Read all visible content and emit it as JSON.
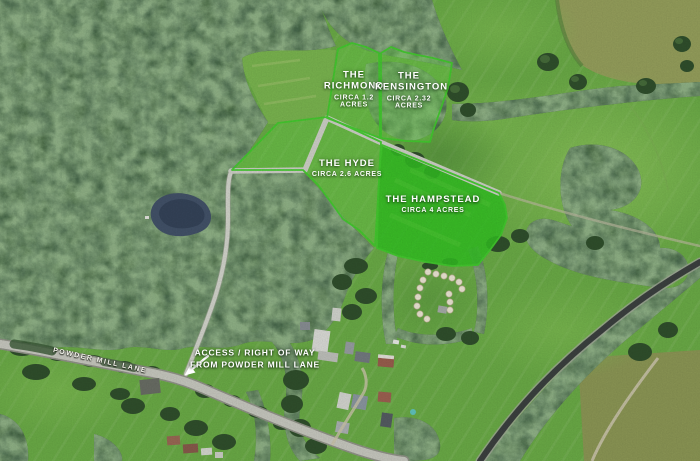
{
  "map_labels": {
    "plots": [
      {
        "name": "THE RICHMOND",
        "area": "CIRCA 1.2 ACRES"
      },
      {
        "name": "THE KENSINGTON",
        "area": "CIRCA 2.32 ACRES"
      },
      {
        "name": "THE HYDE",
        "area": "CIRCA 2.6 ACRES"
      },
      {
        "name": "THE HAMPSTEAD",
        "area": "CIRCA 4 ACRES"
      }
    ],
    "access_note": {
      "line1": "ACCESS / RIGHT OF WAY",
      "line2": "FROM POWDER MILL LANE"
    },
    "road_name": "POWDER MILL LANE"
  },
  "colors": {
    "plot_tint": "rgba(105,215,70,0.38)",
    "plot_highlight": "rgba(50,198,34,0.85)",
    "plot_border": "#43cf2e",
    "label_text": "#ffffff"
  }
}
